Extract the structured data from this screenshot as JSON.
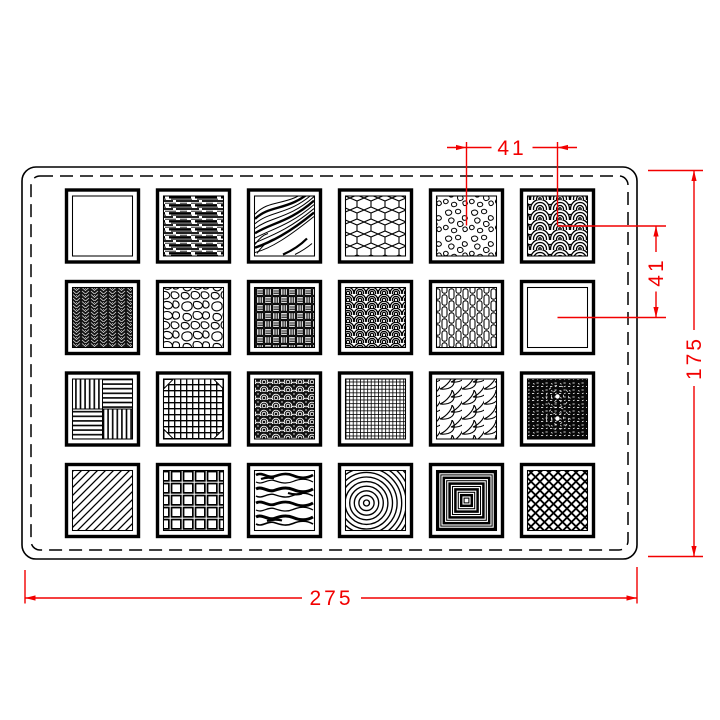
{
  "drawing": {
    "rows": 4,
    "columns": 6,
    "tile_count": 24
  },
  "dimensions": {
    "tile_pitch_horizontal": "41",
    "tile_pitch_vertical": "41",
    "plate_height": "175",
    "plate_width": "275"
  },
  "colors": {
    "dimension_lines": "#f20000",
    "drawing_lines": "#000000",
    "background": "#ffffff"
  },
  "tiles": [
    {
      "row": 1,
      "col": 1,
      "pattern": "blank"
    },
    {
      "row": 1,
      "col": 2,
      "pattern": "wood-grain-straight"
    },
    {
      "row": 1,
      "col": 3,
      "pattern": "wood-grain-curved"
    },
    {
      "row": 1,
      "col": 4,
      "pattern": "cubes"
    },
    {
      "row": 1,
      "col": 5,
      "pattern": "gravel"
    },
    {
      "row": 1,
      "col": 6,
      "pattern": "seigaiha-waves"
    },
    {
      "row": 2,
      "col": 1,
      "pattern": "dark-knit"
    },
    {
      "row": 2,
      "col": 2,
      "pattern": "cobblestone"
    },
    {
      "row": 2,
      "col": 3,
      "pattern": "basket-weave"
    },
    {
      "row": 2,
      "col": 4,
      "pattern": "pine-scales"
    },
    {
      "row": 2,
      "col": 5,
      "pattern": "woven-strips"
    },
    {
      "row": 2,
      "col": 6,
      "pattern": "blank"
    },
    {
      "row": 3,
      "col": 1,
      "pattern": "parquet"
    },
    {
      "row": 3,
      "col": 2,
      "pattern": "wire-mesh"
    },
    {
      "row": 3,
      "col": 3,
      "pattern": "rosette-band"
    },
    {
      "row": 3,
      "col": 4,
      "pattern": "fine-grid"
    },
    {
      "row": 3,
      "col": 5,
      "pattern": "leaf-scales"
    },
    {
      "row": 3,
      "col": 6,
      "pattern": "starburst"
    },
    {
      "row": 4,
      "col": 1,
      "pattern": "diagonal-hatch"
    },
    {
      "row": 4,
      "col": 2,
      "pattern": "plaid"
    },
    {
      "row": 4,
      "col": 3,
      "pattern": "water-waves"
    },
    {
      "row": 4,
      "col": 4,
      "pattern": "concentric-circles"
    },
    {
      "row": 4,
      "col": 5,
      "pattern": "concentric-squares"
    },
    {
      "row": 4,
      "col": 6,
      "pattern": "diamond-net"
    }
  ]
}
